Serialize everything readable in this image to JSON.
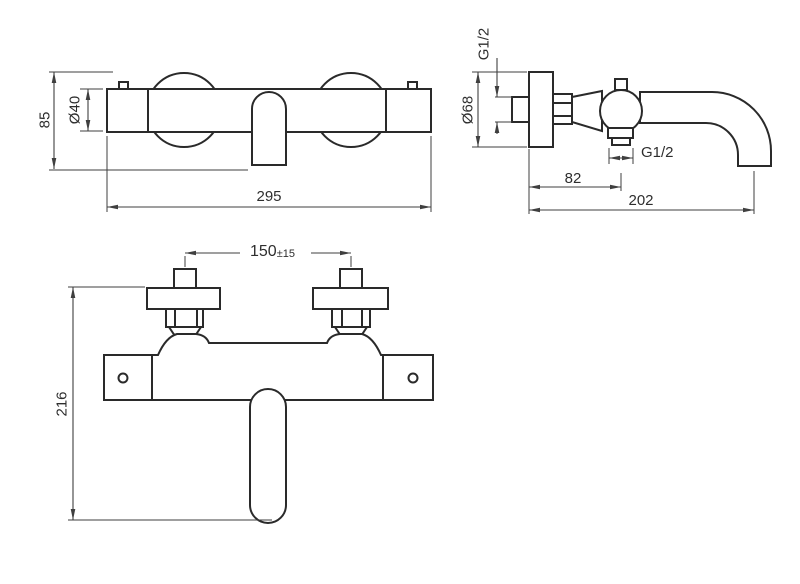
{
  "dims": {
    "front": {
      "height": "85",
      "bar_diameter": "Ø40",
      "width": "295"
    },
    "side": {
      "inlet_thread": "G1/2",
      "flange_diameter": "Ø68",
      "outlet_thread": "G1/2",
      "outlet_offset": "82",
      "reach": "202"
    },
    "plan": {
      "inlet_spacing": "150",
      "inlet_spacing_tolerance": "±15",
      "overall_height": "216"
    }
  },
  "colors": {
    "background": "#ffffff",
    "part_line": "#2a2a2a",
    "dimension_line": "#3f3f3f",
    "text": "#2e2e2e"
  }
}
